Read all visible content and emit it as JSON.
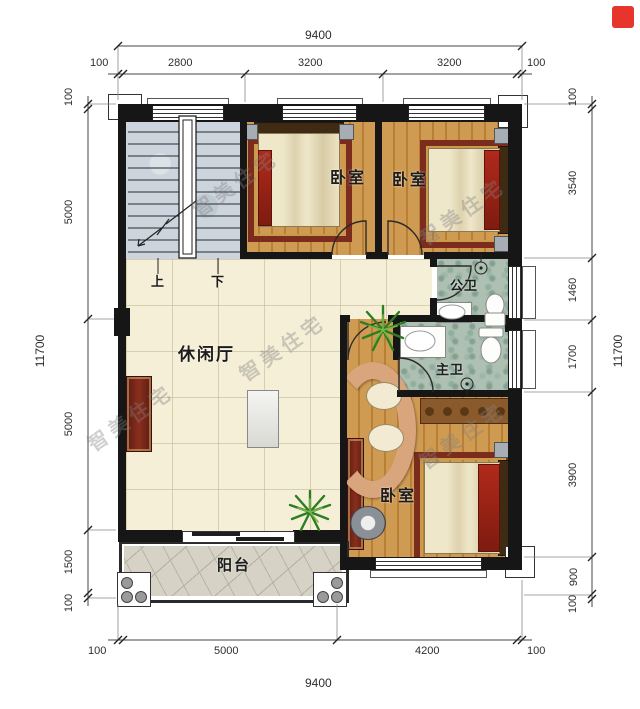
{
  "watermark_text": "智美住宅",
  "rooms": [
    {
      "id": "bedroom-1",
      "label": "卧室"
    },
    {
      "id": "bedroom-2",
      "label": "卧室"
    },
    {
      "id": "bedroom-3",
      "label": "卧室"
    },
    {
      "id": "bath-public",
      "label": "公卫"
    },
    {
      "id": "bath-master",
      "label": "主卫"
    },
    {
      "id": "leisure-hall",
      "label": "休闲厅"
    },
    {
      "id": "balcony",
      "label": "阳台"
    }
  ],
  "stairs": {
    "up_label": "上",
    "down_label": "下"
  },
  "dimensions": {
    "top": {
      "total": "9400",
      "segments": [
        "100",
        "2800",
        "3200",
        "3200",
        "100"
      ]
    },
    "bottom": {
      "total": "9400",
      "segments": [
        "100",
        "5000",
        "4200",
        "100"
      ]
    },
    "left": {
      "total": "11700",
      "segments": [
        "100",
        "5000",
        "5000",
        "1500",
        "100"
      ]
    },
    "right": {
      "total": "11700",
      "segments": [
        "100",
        "3540",
        "1460",
        "1700",
        "3900",
        "900",
        "100"
      ]
    }
  },
  "colors": {
    "wall": "#161616",
    "wood_floor": "#c98f45",
    "tile_floor": "#f6efd7",
    "marble_floor": "#adc0b2",
    "stone_floor": "#d6d2c5",
    "stair_floor": "#ccd5dd",
    "accent_red": "#a5281c",
    "logo_red": "#e8352b"
  }
}
